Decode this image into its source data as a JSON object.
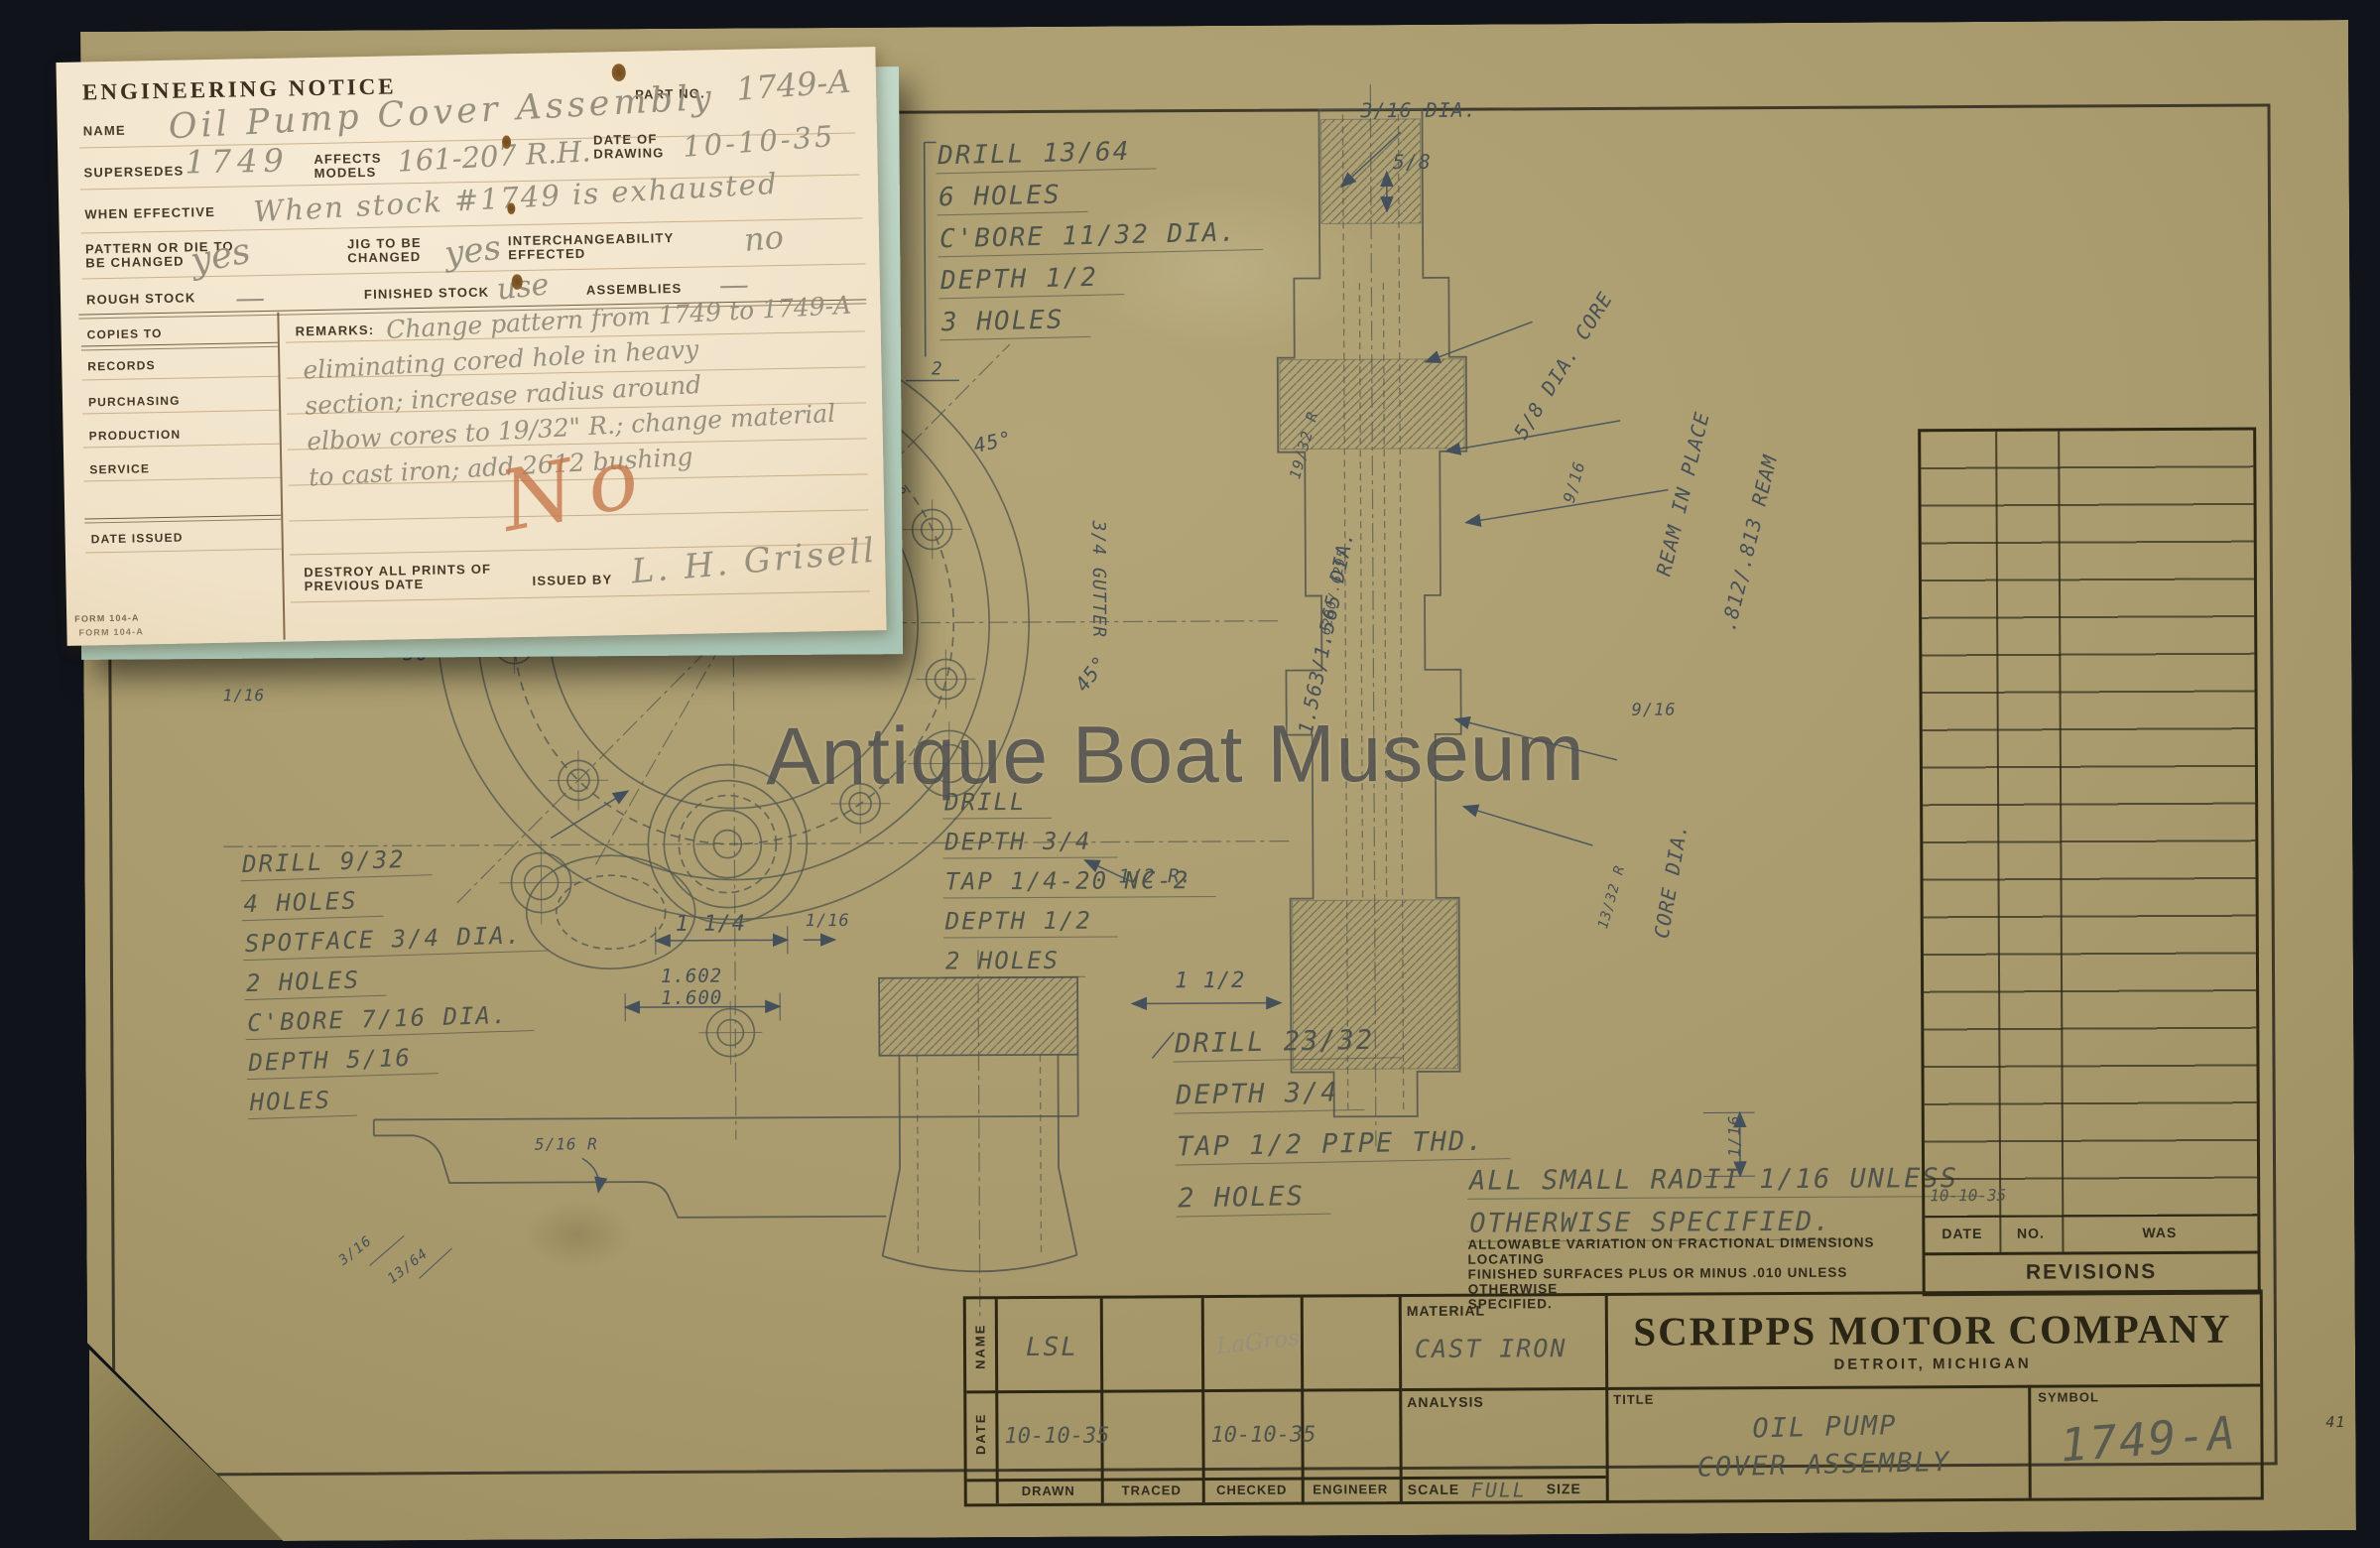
{
  "watermark": "Antique Boat Museum",
  "colors": {
    "background": "#10141a",
    "sheet_tan": "#a99b6d",
    "ink": "#2c2715",
    "pencil": "#4f534b",
    "dim_pencil": "#475059",
    "card_cream": "#f3e7cf",
    "card_under_teal": "#bccfc0",
    "crayon_orange": "#c27a50",
    "watermark_gray": "#5f5f5f"
  },
  "notice_card": {
    "title": "ENGINEERING NOTICE",
    "part_no_label": "PART NO.",
    "part_no_value": "1749-A",
    "name_label": "NAME",
    "name_value": "Oil Pump Cover Assembly",
    "supersedes_label": "SUPERSEDES",
    "supersedes_value": "1749",
    "affects_label": "AFFECTS MODELS",
    "affects_value": "161-207 R.H.",
    "date_of_drawing_label": "DATE OF DRAWING",
    "date_of_drawing_value": "10-10-35",
    "when_effective_label": "WHEN EFFECTIVE",
    "when_effective_value": "When stock #1749 is exhausted",
    "pattern_label": "PATTERN OR DIE TO BE CHANGED",
    "pattern_value": "yes",
    "jig_label": "JIG TO BE CHANGED",
    "jig_value": "yes",
    "interchangeability_label": "INTERCHANGEABILITY EFFECTED",
    "interchangeability_value": "no",
    "rough_stock_label": "ROUGH STOCK",
    "rough_stock_value": "—",
    "finished_stock_label": "FINISHED STOCK",
    "finished_stock_value": "use",
    "assemblies_label": "ASSEMBLIES",
    "assemblies_value": "—",
    "copies_to_label": "COPIES TO",
    "copies_rows": [
      "RECORDS",
      "PURCHASING",
      "PRODUCTION",
      "SERVICE"
    ],
    "date_issued_label": "DATE ISSUED",
    "remarks_label": "REMARKS:",
    "remarks_lines": [
      "Change pattern from 1749 to 1749-A",
      "eliminating cored hole in heavy",
      "section; increase radius around",
      "elbow cores to 19/32\" R.; change material",
      "to cast iron; add 2612 bushing"
    ],
    "approval_mark": "No",
    "destroy_label": "DESTROY ALL PRINTS OF PREVIOUS DATE",
    "issued_by_label": "ISSUED BY",
    "issued_by_signature": "L. H. Grisell",
    "form_no": "FORM 104-A"
  },
  "sheet": {
    "drill_notes": {
      "block_tl": [
        "DRILL 13/64",
        "6 HOLES",
        "C'BORE 11/32 DIA.",
        "DEPTH 1/2",
        "3 HOLES"
      ],
      "block_left": [
        "DRILL 9/32",
        "4 HOLES",
        "SPOTFACE 3/4 DIA.",
        "2 HOLES",
        "C'BORE 7/16 DIA.",
        "DEPTH 5/16",
        "HOLES"
      ],
      "block_mid": [
        "DRILL",
        "DEPTH 3/4",
        "TAP 1/4-20 NC-2",
        "DEPTH 1/2",
        "2 HOLES"
      ],
      "block_low": [
        "DRILL 23/32",
        "DEPTH 3/4",
        "TAP 1/2 PIPE THD.",
        "2 HOLES"
      ]
    },
    "radii_note": [
      "ALL SMALL RADII 1/16 UNLESS",
      "OTHERWISE SPECIFIED."
    ],
    "allowable_note": [
      "ALLOWABLE VARIATION ON FRACTIONAL DIMENSIONS LOCATING",
      "FINISHED SURFACES PLUS OR MINUS .010 UNLESS OTHERWISE",
      "SPECIFIED."
    ],
    "dims": {
      "dia316": "3/16 DIA.",
      "f58": "5/8",
      "core58": "5/8 DIA. CORE",
      "ream_place": "REAM IN PLACE",
      "ream_val": ".812/.813 REAM",
      "dia1563": "1.563/1.565 DIA.",
      "dia6280": ".6280/.6295",
      "r1932": "19/32 R",
      "f916a": "9/16",
      "f916b": "9/16",
      "core_dia": "CORE DIA.",
      "r1332": "13/32 R",
      "r12": "1/2 R.",
      "f112": "1 1/2",
      "f114": "1 1/4",
      "f116a": "1/16",
      "v1602": "1.602",
      "v1600": "1.600",
      "a45a": "45°",
      "a120": "120°",
      "a45b": "45°",
      "a50": "50°",
      "f18": "1/8",
      "f116b": "1/16",
      "gutter": "3/4 GUTTER",
      "r516": "5/16 R",
      "f316": "3/16",
      "f1364": "13/64",
      "f116c": "1/16",
      "d2": "2"
    },
    "corner_mark": "41"
  },
  "title_block": {
    "company": "SCRIPPS MOTOR COMPANY",
    "city": "DETROIT, MICHIGAN",
    "title_label": "TITLE",
    "title_line1": "OIL PUMP",
    "title_line2": "COVER ASSEMBLY",
    "symbol_label": "SYMBOL",
    "symbol_value": "1749-A",
    "material_label": "MATERIAL",
    "material_value": "CAST IRON",
    "analysis_label": "ANALYSIS",
    "scale_label": "SCALE",
    "scale_value": "FULL",
    "size_label": "SIZE",
    "name_row_label": "NAME",
    "date_row_label": "DATE",
    "drawn_label": "DRAWN",
    "traced_label": "TRACED",
    "checked_label": "CHECKED",
    "engineer_label": "ENGINEER",
    "drawn_name": "LSL",
    "checked_signature": "LaGros",
    "drawn_date": "10-10-35",
    "checked_date": "10-10-35"
  },
  "revisions": {
    "date_label": "DATE",
    "no_label": "NO.",
    "was_label": "WAS",
    "title": "REVISIONS",
    "last_entry_date": "10-10-35"
  }
}
